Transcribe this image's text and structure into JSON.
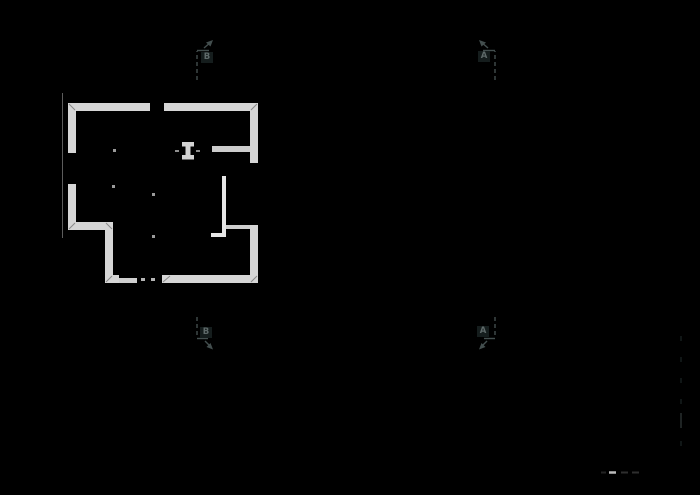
{
  "app": {
    "background_color": "#000000",
    "drawing_type": "architectural-floor-plan"
  },
  "drawing": {
    "wall_fill_color": "#d6d6d6",
    "interior_wall_color": "#cccccc",
    "bright_partition_color": "#e6e6e6",
    "miter_joint_color": "#8a8a8a",
    "column_dot_color": "#9a9a9a",
    "dimension_line_color": "#5c5c5c",
    "section_line_color": "#434e4e",
    "section_label_color": "#5f6a6a",
    "faint_dash_color": "#212b2b",
    "bright_dash_color": "#bcbcbc"
  },
  "section_markers": {
    "b_top": {
      "label": "B"
    },
    "a_top": {
      "label": "A"
    },
    "b_bottom": {
      "label": "B"
    },
    "a_bottom": {
      "label": "A"
    }
  }
}
